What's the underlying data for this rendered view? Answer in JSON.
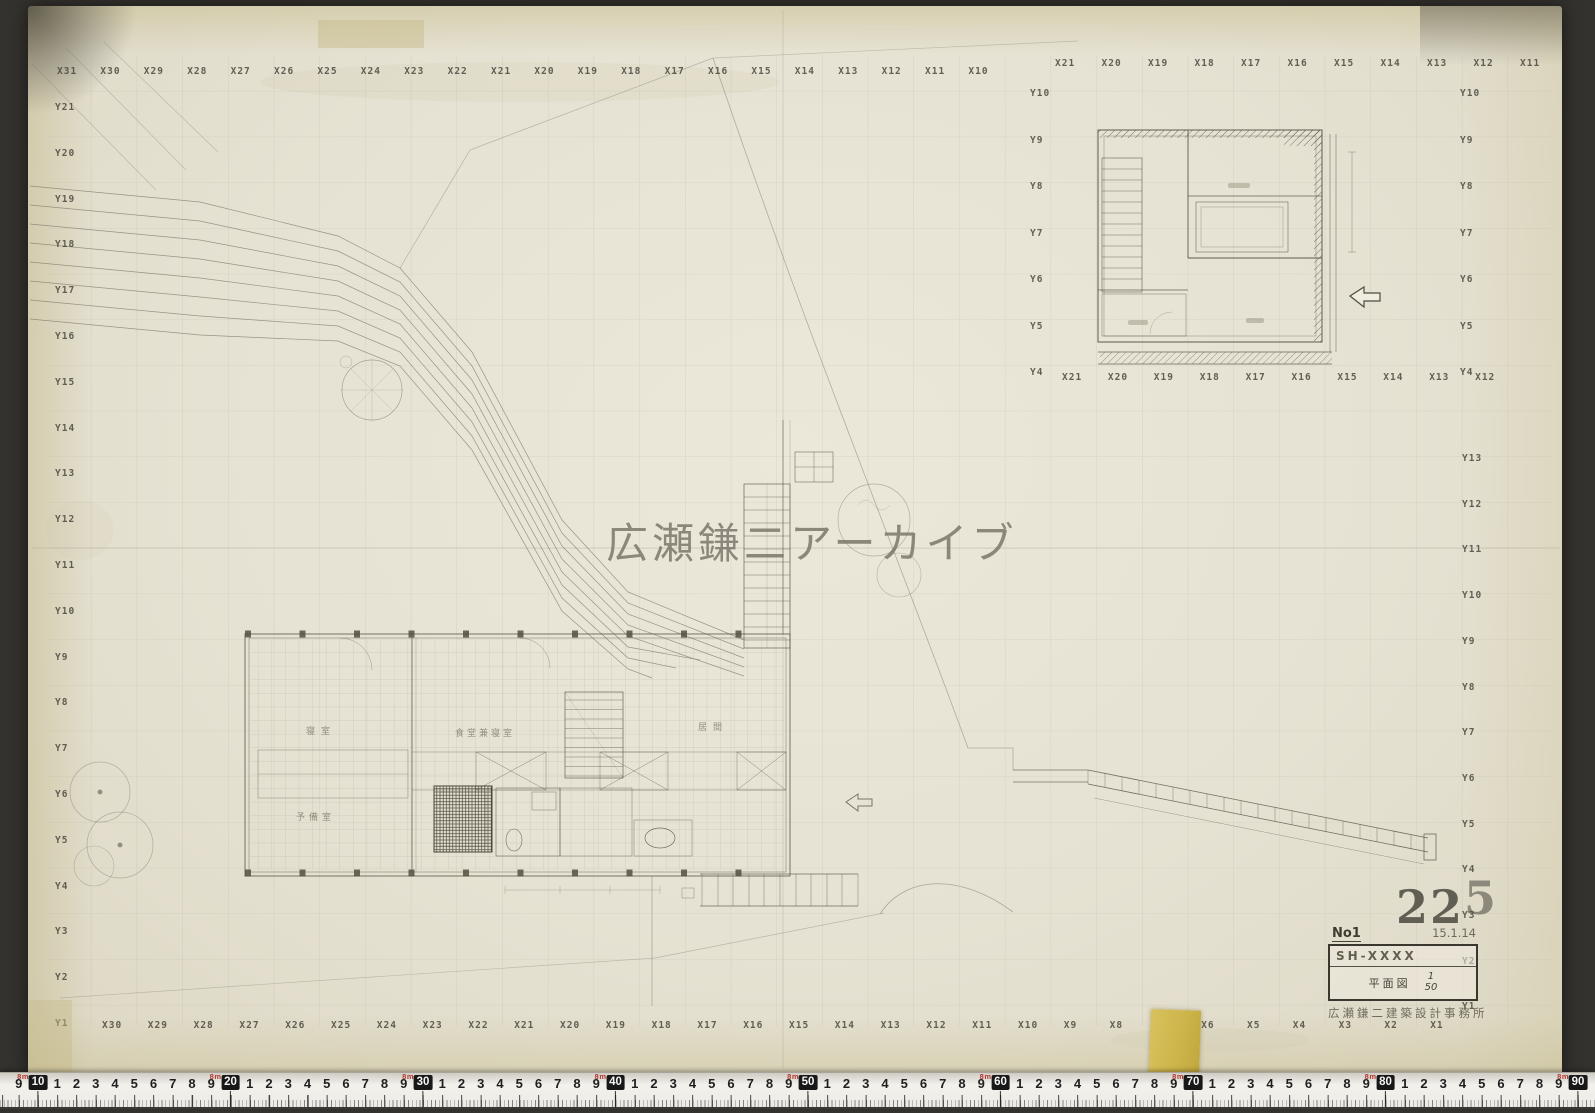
{
  "meta": {
    "watermark": "広瀬鎌二アーカイブ",
    "stamp_main": "22",
    "stamp_sup": "5"
  },
  "title_block": {
    "no": "No1",
    "date": "15.1.14",
    "code": "SH-XXXX",
    "drawing_title": "平面図",
    "scale_top": "1",
    "scale_bottom": "50",
    "office": "広瀬鎌二建築設計事務所"
  },
  "plan": {
    "room_labels": [
      "寝室",
      "食堂兼寝室",
      "居間",
      "予備室"
    ]
  },
  "grid": {
    "top_row": [
      "X31",
      "X30",
      "X29",
      "X28",
      "X27",
      "X26",
      "X25",
      "X24",
      "X23",
      "X22",
      "X21",
      "X20",
      "X19",
      "X18",
      "X17",
      "X16",
      "X15",
      "X14",
      "X13",
      "X12",
      "X11",
      "X10"
    ],
    "top_detail_row": [
      "X21",
      "X20",
      "X19",
      "X18",
      "X17",
      "X16",
      "X15",
      "X14",
      "X13",
      "X12",
      "X11"
    ],
    "bottom_row": [
      "X30",
      "X29",
      "X28",
      "X27",
      "X26",
      "X25",
      "X24",
      "X23",
      "X22",
      "X21",
      "X20",
      "X19",
      "X18",
      "X17",
      "X16",
      "X15",
      "X14",
      "X13",
      "X12",
      "X11",
      "X10",
      "X9",
      "X8",
      "X7",
      "X6",
      "X5",
      "X4",
      "X3",
      "X2",
      "X1"
    ],
    "left_col": [
      "Y21",
      "Y20",
      "Y19",
      "Y18",
      "Y17",
      "Y16",
      "Y15",
      "Y14",
      "Y13",
      "Y12",
      "Y11",
      "Y10",
      "Y9",
      "Y8",
      "Y7",
      "Y6",
      "Y5",
      "Y4",
      "Y3",
      "Y2",
      "Y1"
    ],
    "right_detail_col": [
      "Y10",
      "Y9",
      "Y8",
      "Y7",
      "Y6",
      "Y5",
      "Y4"
    ],
    "right_main_col": [
      "Y13",
      "Y12",
      "Y11",
      "Y10",
      "Y9",
      "Y8",
      "Y7",
      "Y6",
      "Y5",
      "Y4",
      "Y3",
      "Y2",
      "Y1"
    ],
    "detail_left_col": [
      "Y10",
      "Y9",
      "Y8",
      "Y7",
      "Y6",
      "Y5",
      "Y4"
    ],
    "detail_bottom_row": [
      "X21",
      "X20",
      "X19",
      "X18",
      "X17",
      "X16",
      "X15",
      "X14",
      "X13",
      "X12"
    ]
  },
  "ruler": {
    "leading": "9",
    "decades": [
      "10",
      "20",
      "30",
      "40",
      "50",
      "60",
      "70",
      "80",
      "90"
    ],
    "digits": [
      "1",
      "2",
      "3",
      "4",
      "5",
      "6",
      "7",
      "8",
      "9"
    ],
    "meter_label": "8m",
    "accent_color": "#b5372e"
  },
  "colors": {
    "paper": "#e7e3d4",
    "pencil": "#555146",
    "watermark": "#767166"
  }
}
